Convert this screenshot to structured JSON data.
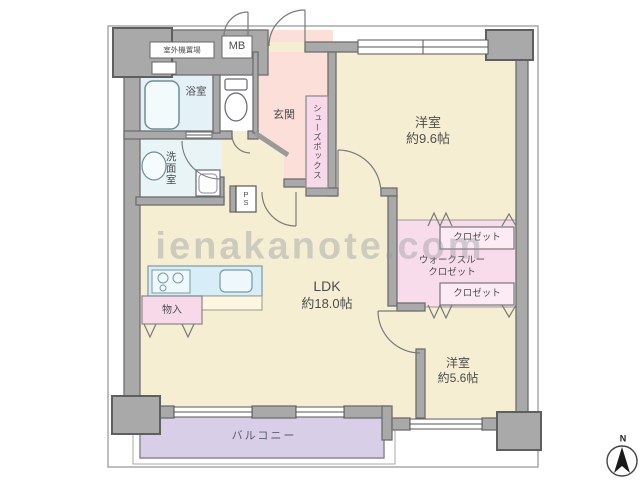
{
  "watermark": "ienakanote.com",
  "compass": {
    "north_label": "N"
  },
  "rooms": {
    "ldk": {
      "name": "LDK",
      "size": "約18.0帖"
    },
    "bedroom1": {
      "name": "洋室",
      "size": "約9.6帖"
    },
    "bedroom2": {
      "name": "洋室",
      "size": "約5.6帖"
    },
    "balcony": {
      "name": "バルコニー"
    },
    "bath": {
      "name": "浴室"
    },
    "washroom": {
      "name": "洗面室"
    },
    "entrance": {
      "name": "玄関"
    },
    "shoe_box": {
      "name": "シューズボックス"
    },
    "closet_top": {
      "name": "クロゼット"
    },
    "closet_bottom": {
      "name": "クロゼット"
    },
    "walk_through_closet": {
      "line1": "ウォークスルー",
      "line2": "クロゼット"
    },
    "storage": {
      "name": "物入"
    },
    "meter_box": {
      "name": "MB"
    },
    "pipe_space": {
      "line1": "P",
      "line2": "S"
    },
    "outdoor_unit": {
      "name": "室外機置場"
    }
  },
  "colors": {
    "wall": "#a9a9a9",
    "room_cream": "#f6eed3",
    "entrance_pink": "#fbdfd8",
    "closet_pink": "#f8dcec",
    "bath_blue": "#e4f1f6",
    "kitchen_blue": "#d7edf8",
    "balcony_purple": "#d9cee8"
  }
}
